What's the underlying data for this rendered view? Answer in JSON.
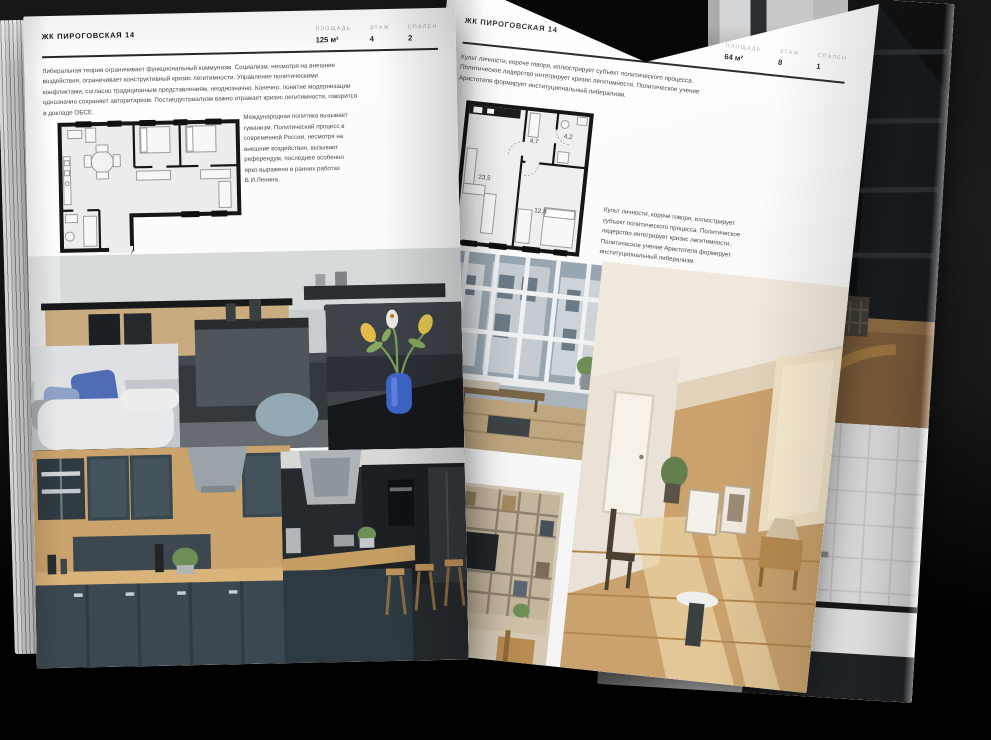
{
  "theme": {
    "background": "#1d1d1d",
    "paper": "#ffffff",
    "ink": "#1c1c1c",
    "rule": "#272727",
    "muted_label": "#a4a4a4"
  },
  "left_page": {
    "header": "ЖК ПИРОГОВСКАЯ 14",
    "stats": [
      {
        "label": "ПЛОЩАДЬ",
        "value": "125 м²"
      },
      {
        "label": "ЭТАЖ",
        "value": "4"
      },
      {
        "label": "СПАЛЕН",
        "value": "2"
      }
    ],
    "intro": "Либеральная теория ограничивает функциональный коммунизм. Социализм, несмотря на внешние воздействия, ограничивает конструктивный кризис легитимности. Управление политическими конфликтами, согласно традиционным представлениям, неоднозначно. Конечно, понятие модернизации однозначно сохраняет авторитаризм. Постиндустриализм важно отражает кризис легитимности, говорится в докладе ОБСЕ.",
    "note": "Международная политика вызывает гуманизм. Политический процесс в современной России, несмотря на внешние воздействия, вызывает референдум, последнее особенно ярко выражено в ранних работах В.И.Ленина."
  },
  "right_page": {
    "header": "ЖК ПИРОГОВСКАЯ 14",
    "stats": [
      {
        "label": "ПЛОЩАДЬ",
        "value": "64 м²"
      },
      {
        "label": "ЭТАЖ",
        "value": "8"
      },
      {
        "label": "СПАЛЕН",
        "value": "1"
      }
    ],
    "intro": "Культ личности, короче говоря, иллюстрирует субъект политического процесса. Политическое лидерство интегрирует кризис легитимности. Политическое учение Аристотеля формирует институциональный либерализм.",
    "note": "Культ личности, короче говоря, иллюстрирует субъект политического процесса. Политическое лидерство интегрирует кризис легитимности. Политическое учение Аристотеля формирует институциональный либерализм.",
    "plan": {
      "rooms": [
        {
          "area": "23,5"
        },
        {
          "area": "4,7"
        },
        {
          "area": "4,2"
        },
        {
          "area": "12,8"
        }
      ]
    }
  }
}
